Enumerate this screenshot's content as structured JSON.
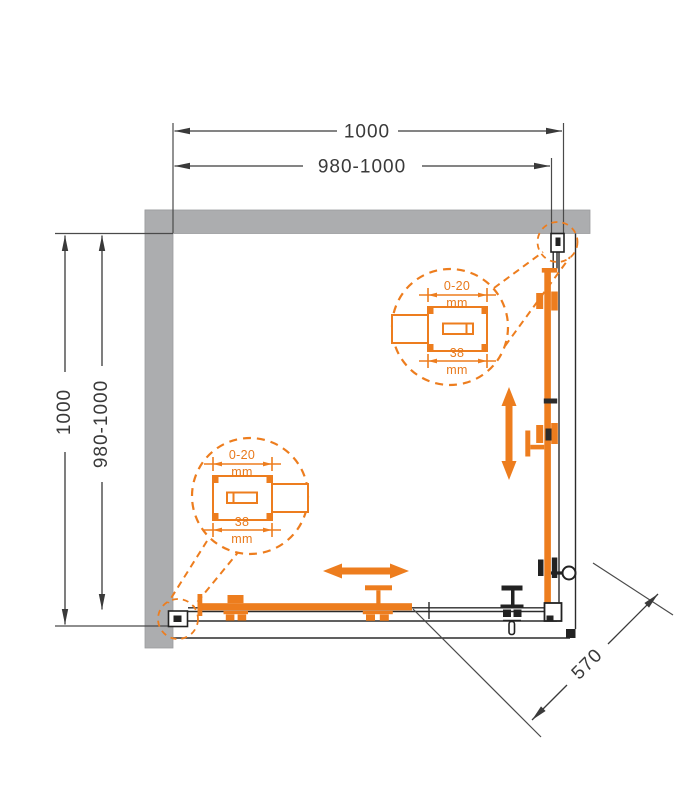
{
  "drawing": {
    "title_hint": "corner shower enclosure top view technical drawing",
    "dimensions": {
      "width_outer": "1000",
      "width_range": "980-1000",
      "depth_outer": "1000",
      "depth_range": "980-1000",
      "entry_diagonal": "570"
    },
    "profile_detail": {
      "adjustment": "0-20",
      "unit": "mm",
      "width": "38"
    },
    "colors": {
      "accent_orange": "#ED7D1E",
      "wall_gray": "#ACADAF",
      "line_dark": "#2B2B2B"
    }
  }
}
